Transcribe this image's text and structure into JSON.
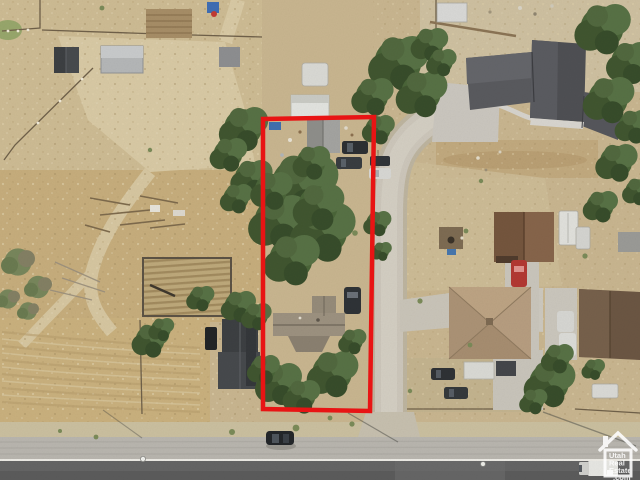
{
  "image": {
    "kind": "aerial-drone-photo",
    "width": 640,
    "height": 480,
    "subject": "residential parcel outlined in red beside a road, surrounded by dirt fields, trees and neighboring houses"
  },
  "overlay": {
    "boundary_color": "#e81414"
  },
  "watermark": {
    "color": "#ffffff",
    "lines": [
      "Utah",
      "Real",
      "Estate",
      ".com"
    ]
  },
  "palette": {
    "dirt": "#c8b58f",
    "dry_grass": "#c6ad7c",
    "light_track": "#d8c9a4",
    "tree_green": "#4a6438",
    "concrete": "#b8b5ae",
    "asphalt": "#646464",
    "roof_dark_gray": "#4e4f53",
    "roof_brown": "#74553d",
    "roof_tan_hip": "#b2997c",
    "roof_subject": "#988e7d"
  }
}
